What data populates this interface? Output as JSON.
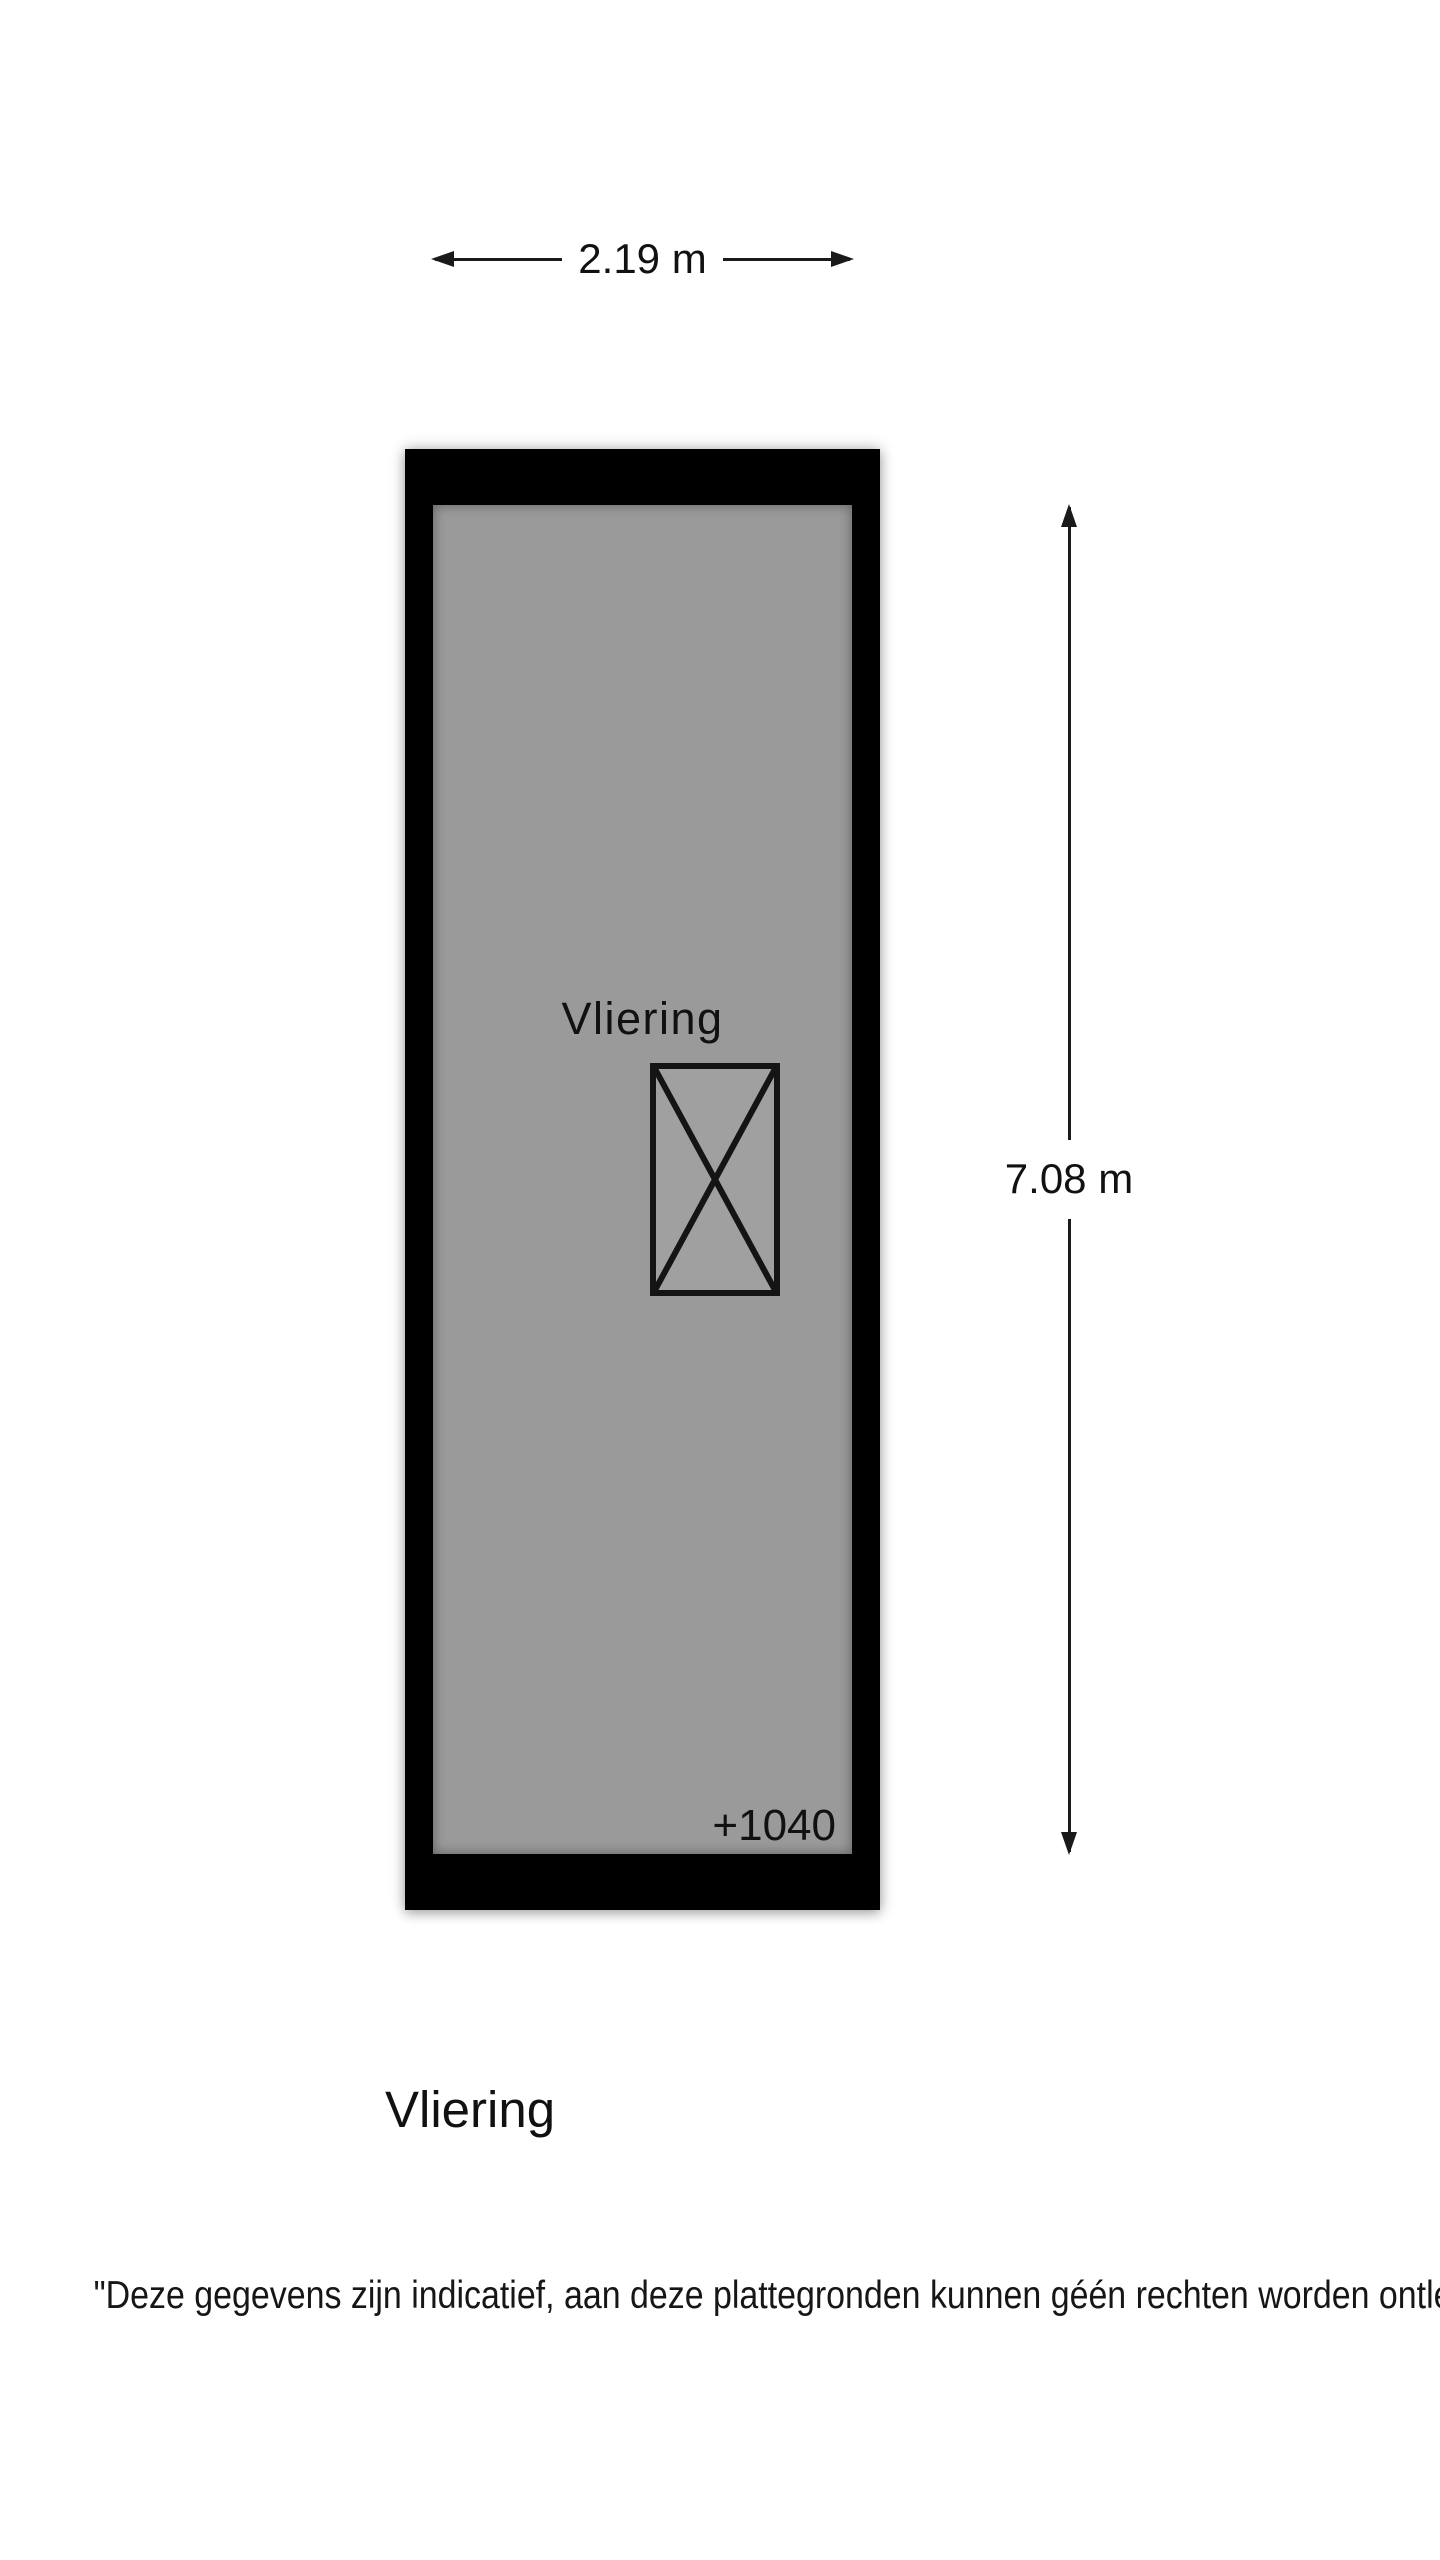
{
  "page": {
    "background_color": "#ffffff",
    "text_color": "#111111"
  },
  "floorplan": {
    "room_label": "Vliering",
    "level_annotation": "+1040",
    "width_dimension": {
      "label": "2.19 m"
    },
    "height_dimension": {
      "label": "7.08 m"
    },
    "colors": {
      "wall": "#000000",
      "floor": "#9a9a9a",
      "dimension_line": "#1a1a1a"
    },
    "symbols": [
      {
        "name": "hatch-opening-icon",
        "shape": "rectangle-with-diagonal-cross"
      }
    ]
  },
  "title": "Vliering",
  "disclaimer": "\"Deze gegevens zijn indicatief, aan deze plattegronden kunnen géén rechten worden ontleend\""
}
